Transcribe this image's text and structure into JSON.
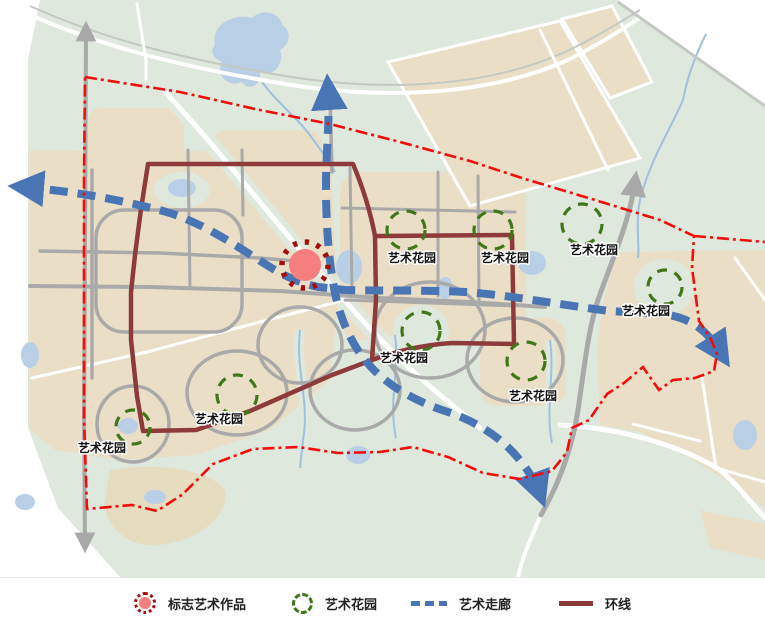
{
  "title": "艺术设施规划图",
  "colors": {
    "land": "#dfe8dd",
    "parcel": "#eadfc6",
    "parcel_muted": "#e6dcc0",
    "water": "#b9cfe6",
    "river": "#9fc0dd",
    "road_gray": "#a9a9a9",
    "road_white": "#ffffff",
    "corridor_blue": "#4a75b5",
    "ring_maroon": "#8e3a3b",
    "boundary_red": "#f40b0b",
    "garden_green": "#41761a",
    "landmark_fill": "#f57e7e",
    "landmark_ring": "#a50d0d"
  },
  "map": {
    "landmark": {
      "cx": 305,
      "cy": 265,
      "ring_r": 23,
      "core_r": 16
    },
    "gardens": [
      {
        "label": "艺术花园",
        "cx": 406,
        "cy": 230,
        "r": 19,
        "lx": 412,
        "ly": 258
      },
      {
        "label": "艺术花园",
        "cx": 493,
        "cy": 230,
        "r": 19,
        "lx": 505,
        "ly": 258
      },
      {
        "label": "艺术花园",
        "cx": 582,
        "cy": 224,
        "r": 20,
        "lx": 594,
        "ly": 250
      },
      {
        "label": "艺术花园",
        "cx": 665,
        "cy": 287,
        "r": 17,
        "lx": 646,
        "ly": 311
      },
      {
        "label": "艺术花园",
        "cx": 421,
        "cy": 331,
        "r": 19,
        "lx": 404,
        "ly": 358
      },
      {
        "label": "艺术花园",
        "cx": 526,
        "cy": 361,
        "r": 19,
        "lx": 533,
        "ly": 396
      },
      {
        "label": "艺术花园",
        "cx": 237,
        "cy": 395,
        "r": 20,
        "lx": 219,
        "ly": 419
      },
      {
        "label": "艺术花园",
        "cx": 133,
        "cy": 427,
        "r": 17,
        "lx": 102,
        "ly": 448
      }
    ]
  },
  "legend": {
    "items": [
      {
        "icon": "landmark-artwork-icon",
        "label": "标志艺术作品"
      },
      {
        "icon": "art-garden-icon",
        "label": "艺术花园"
      },
      {
        "icon": "art-corridor-icon",
        "label": "艺术走廊"
      },
      {
        "icon": "ring-line-icon",
        "label": "环线"
      }
    ]
  }
}
